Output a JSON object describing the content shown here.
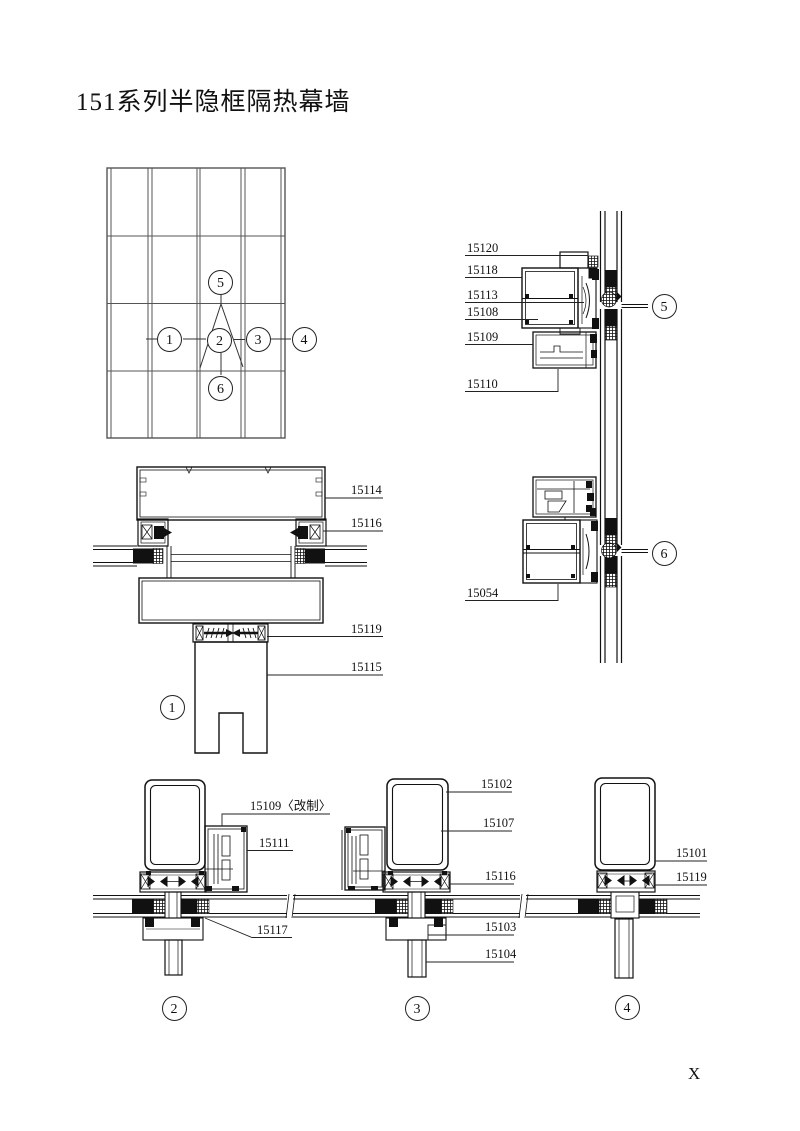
{
  "title": "151系列半隐框隔热幕墙",
  "page_mark": "X",
  "colors": {
    "ink": "#1a1a1a",
    "paper": "#ffffff"
  },
  "section_markers": {
    "s1": "1",
    "s2": "2",
    "s3": "3",
    "s4": "4",
    "s5": "5",
    "s6": "6"
  },
  "part_labels": {
    "detail5": [
      "15120",
      "15118",
      "15113",
      "15108",
      "15109",
      "15110"
    ],
    "detail6": [
      "15054"
    ],
    "detail1": [
      "15114",
      "15116",
      "15119",
      "15115"
    ],
    "detail2": [
      "15109〈改制〉",
      "15111",
      "15117"
    ],
    "detail3": [
      "15102",
      "15107",
      "15116",
      "15103",
      "15104"
    ],
    "detail4": [
      "15101",
      "15119"
    ]
  }
}
